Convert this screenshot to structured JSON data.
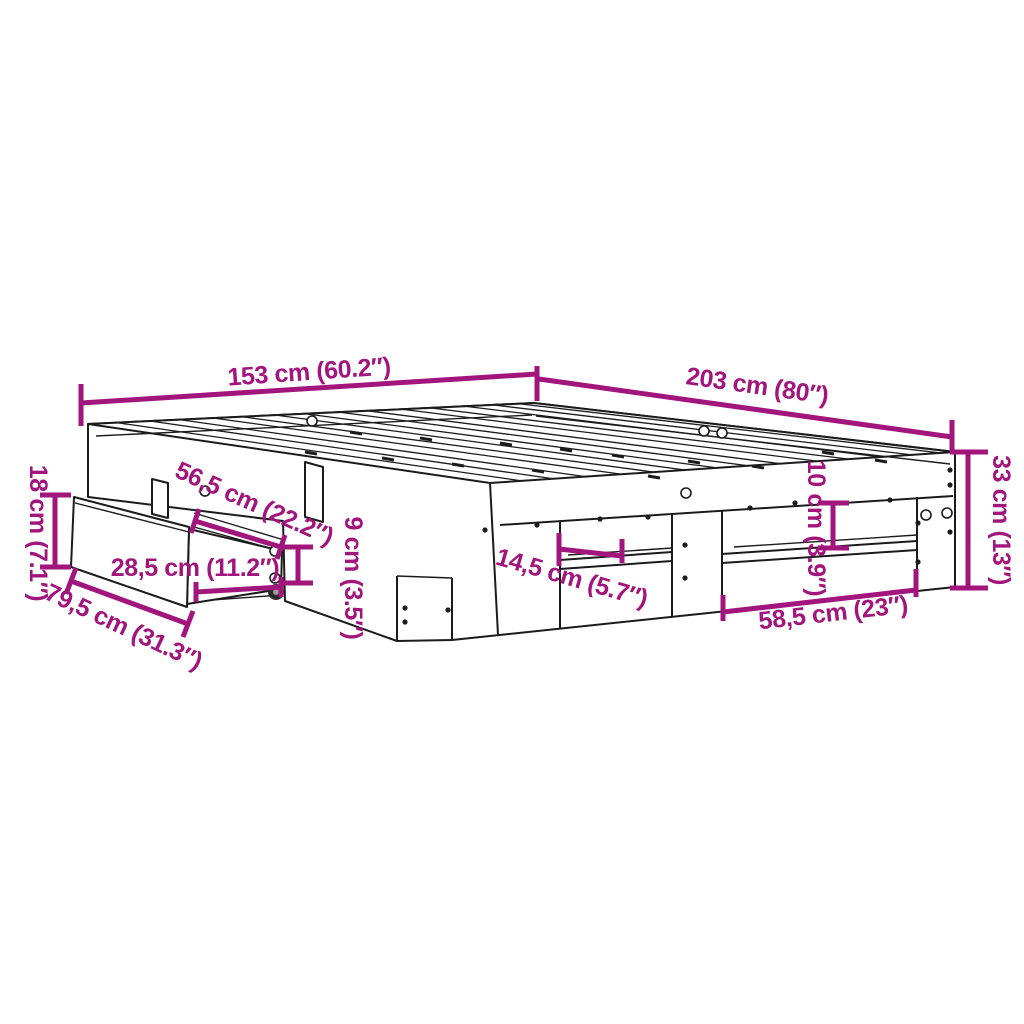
{
  "colors": {
    "dimension_accent": "#A1157D",
    "drawing_line": "#1B1B1B",
    "background": "#FFFFFF"
  },
  "dimensions": {
    "width": "153 cm (60.2″)",
    "length": "203 cm (80″)",
    "frame_height": "33 cm (13″)",
    "drawer_front_height": "18 cm (7.1″)",
    "drawer_slide_length": "56,5 cm (22.2″)",
    "side_rail_height": "9 cm (3.5″)",
    "drawer_depth": "28,5 cm (11.2″)",
    "drawer_front_width": "79,5 cm (31.3″)",
    "shelf_depth": "14,5 cm (5.7″)",
    "shelf_clearance": "10 cm (3.9″)",
    "opening_width": "58,5 cm (23″)"
  }
}
